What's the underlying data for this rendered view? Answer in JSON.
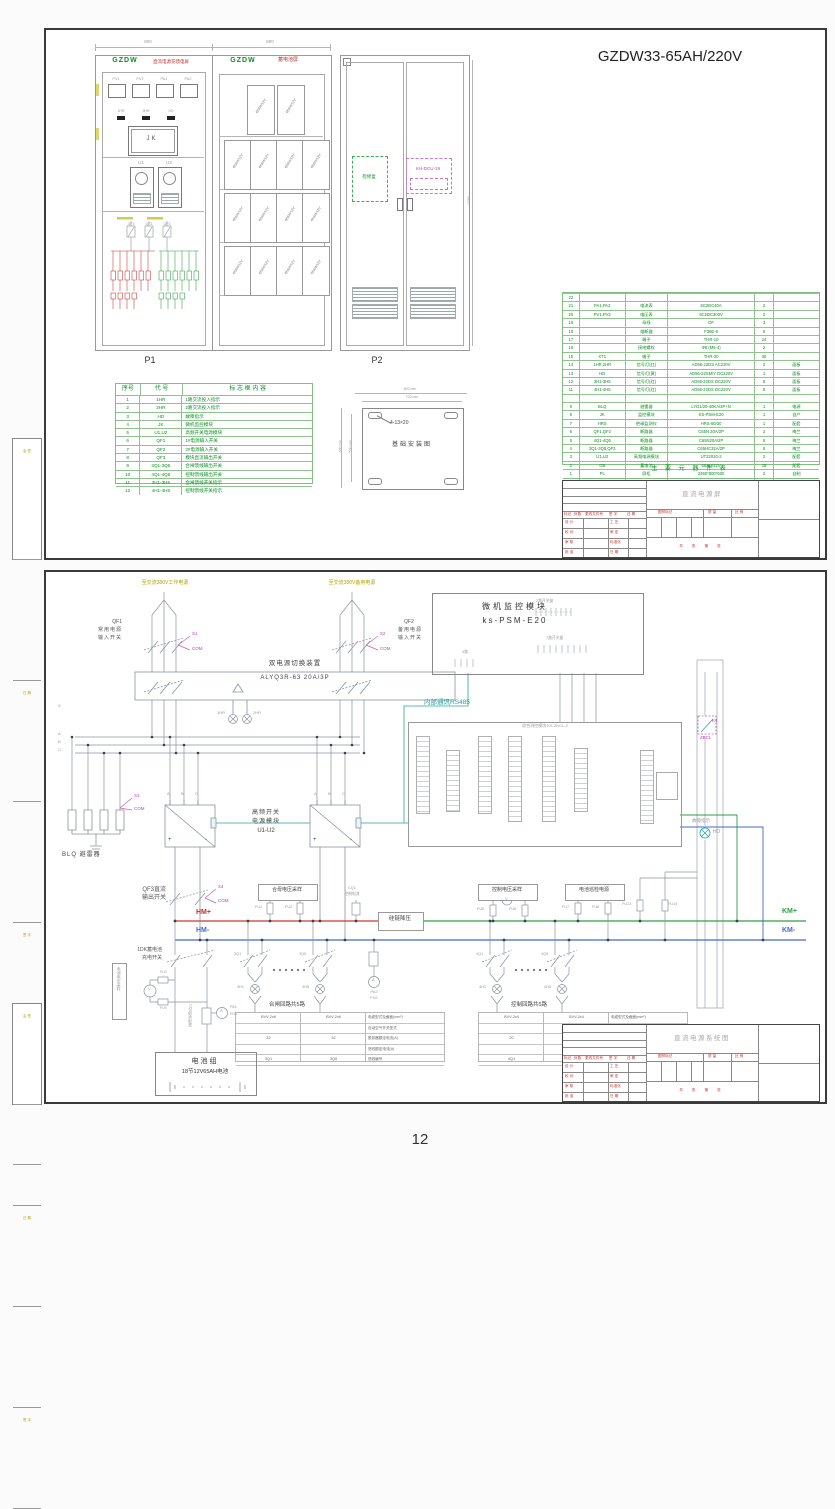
{
  "page": {
    "number": "12"
  },
  "margin": {
    "labels": [
      "会 签",
      "日 期",
      "签 字",
      "审 定"
    ]
  },
  "titleblock": {
    "rev_cols": [
      "标记",
      "处数",
      "更改文件号",
      "签 字",
      "日 期"
    ],
    "sig_left": [
      "设 计",
      "校 对",
      "审 核",
      "批 准"
    ],
    "sig_right": [
      "工 艺",
      "审 定",
      "标准化",
      "日 期"
    ],
    "mark_cols": [
      "图样标记",
      "质 量",
      "比 例"
    ],
    "sheet_info": "共  张  第  张",
    "product1": "直流电源屏",
    "product2": "直流电源系统图"
  },
  "sheet1": {
    "title": "GZDW33-65AH/220V",
    "dims": {
      "w1": "800",
      "w2": "800",
      "h": "2360"
    },
    "p1": {
      "code": "GZDW",
      "name": "直流电源充馈电屏",
      "label": "P1",
      "meters": [
        "PV1",
        "PV2",
        "PA1",
        "PA2"
      ],
      "lamps": [
        "1HR",
        "2HR",
        "HD"
      ],
      "jk": "JK",
      "u": [
        "U1",
        "U2"
      ],
      "breakers": [
        "QF1",
        "QF2",
        "QF3"
      ]
    },
    "p2": {
      "code": "GZDW",
      "name": "蓄电池屏",
      "label": "P2",
      "battery": "65AH/12V"
    },
    "rear": {
      "jxh": "检修盒",
      "dcu": "KH-DCU-19"
    },
    "legend": {
      "headers": [
        "序号",
        "代  号",
        "标 志 框 内 容"
      ],
      "rows": [
        [
          "1",
          "1HR",
          "1路交流投入指示"
        ],
        [
          "2",
          "2HR",
          "2路交流投入指示"
        ],
        [
          "3",
          "HD",
          "故障指示"
        ],
        [
          "4",
          "JK",
          "微机监控模块"
        ],
        [
          "5",
          "U1,U2",
          "高频开关电源模块"
        ],
        [
          "6",
          "QF1",
          "1#电源输入开关"
        ],
        [
          "7",
          "QF2",
          "2#电源输入开关"
        ],
        [
          "8",
          "QF3",
          "模块直流输出开关"
        ],
        [
          "9",
          "3Q1-3Q5",
          "合闸馈线输出开关"
        ],
        [
          "10",
          "4Q1-4Q5",
          "控制馈线输出开关"
        ],
        [
          "11",
          "3H1-3H5",
          "合闸馈线开关指示"
        ],
        [
          "12",
          "4H1-4H5",
          "控制馈线开关指示"
        ]
      ]
    },
    "foundation": {
      "caption": "基础安装图",
      "w_outer": "800 mm",
      "w_inner": "700 mm",
      "h_outer": "600 mm",
      "h_inner": "500 mm",
      "slot": "4-13×20"
    },
    "bom": {
      "caption": "主 要 元 器 件 表",
      "headers": [
        "序号",
        "代 号",
        "名 称",
        "型 号 及 规 格",
        "数量",
        "备 注"
      ],
      "rows": [
        [
          "22",
          "",
          "",
          "",
          "",
          ""
        ],
        [
          "21",
          "PA1,PA2",
          "电流表",
          "6C2DC40A",
          "2",
          ""
        ],
        [
          "20",
          "PV1,PV2",
          "电压表",
          "6C2DC300V",
          "2",
          ""
        ],
        [
          "19",
          "",
          "母线",
          "OF",
          "3",
          ""
        ],
        [
          "18",
          "",
          "熔断器",
          "F36E-6",
          "5",
          ""
        ],
        [
          "17",
          "",
          "端子",
          "THR-10",
          "24",
          ""
        ],
        [
          "16",
          "",
          "接地螺栓",
          "Φ8 (M6-4)",
          "2",
          ""
        ],
        [
          "15",
          "XT1",
          "端子",
          "THR-30",
          "30",
          ""
        ],
        [
          "14",
          "1HR,2HR",
          "信号灯(红)",
          "AD56-22DS AC220V",
          "2",
          "面板"
        ],
        [
          "13",
          "HD",
          "信号灯(黄)",
          "AD56-22SM/Y DC220V",
          "1",
          "面板"
        ],
        [
          "12",
          "3H1-3H5",
          "信号灯(红)",
          "AD56-22DS DC220V",
          "5",
          "面板"
        ],
        [
          "11",
          "4H1-4H5",
          "信号灯(红)",
          "AD56-22DS DC220V",
          "5",
          "面板"
        ],
        [
          "",
          "",
          "",
          "",
          "",
          ""
        ],
        [
          "9",
          "BLQ",
          "避雷器",
          "LYD1/20-40KA/3P+N",
          "1",
          "电源"
        ],
        [
          "8",
          "JK",
          "监控模块",
          "KS-PSM-E20",
          "1",
          "自产"
        ],
        [
          "7",
          "HRS",
          "绝缘监测仪",
          "HRS-60/30",
          "1",
          "配套"
        ],
        [
          "6",
          "QF1,QF2",
          "断路器",
          "C65N 20A/2P",
          "2",
          "梅兰"
        ],
        [
          "5",
          "4Q1-4Q5",
          "断路器",
          "C65N20A/2P",
          "6",
          "梅兰"
        ],
        [
          "4",
          "3Q1-3Q5,QF3",
          "断路器",
          "C65HC32A/2P",
          "5",
          "梅兰"
        ],
        [
          "3",
          "U1,U2",
          "高频电源模块",
          "UT22010-2",
          "2",
          "配套"
        ],
        [
          "2",
          "GB",
          "蓄电池",
          "65AH/12V",
          "18",
          "配套"
        ],
        [
          "1",
          "PL",
          "屏柜",
          "2360*800*600",
          "2",
          "自制"
        ]
      ]
    }
  },
  "sheet2": {
    "src1": "至交流380V工作电源",
    "src2": "至交流380V备用电源",
    "qf1": {
      "code": "QF1",
      "l1": "常用电源",
      "l2": "输入开关",
      "s": "S1",
      "com": "COM"
    },
    "qf2": {
      "code": "QF2",
      "l1": "备用电源",
      "l2": "输入开关",
      "s": "S2",
      "com": "COM"
    },
    "ats": {
      "name": "双电源切换装置",
      "model": "ALYQ3R-63 20A/3P"
    },
    "lamp1": "1HR",
    "lamp2": "2HR",
    "monitor": {
      "name": "微机监控模块",
      "model": "ks-PSM-E20",
      "io1": "2路开关量",
      "io2": "7路开关量",
      "io3": "4路"
    },
    "rs485": "内部通讯RS485",
    "phases": [
      "X",
      "A",
      "B",
      "C"
    ],
    "blq": {
      "label": "BLQ 避雷器",
      "s": "S3",
      "com": "COM"
    },
    "modules": {
      "l1": "高频开关",
      "l2": "电源模块",
      "l3": "U1-U2",
      "a": "A",
      "b": "B",
      "c": "C",
      "plus": "+",
      "minus": "-"
    },
    "measure": {
      "title": "综合测控模块 KS-ZHCL-2"
    },
    "k4": {
      "l1": "K4",
      "l2": "ZBCL"
    },
    "fault": {
      "label": "故障指示",
      "code": "HD"
    },
    "qf3": {
      "l1": "QF3直流",
      "l2": "输出开关",
      "s": "S4",
      "com": "COM"
    },
    "buses": {
      "hmp": "HM+",
      "hmm": "HM-",
      "kmp": "KM+",
      "kmm": "KM-"
    },
    "gl": "硅链降压",
    "samp_hm": {
      "label": "合母电压采样",
      "f1": "FU1",
      "f2": "FU2"
    },
    "cq1": {
      "l1": "CQ1",
      "l2": "控制电流"
    },
    "samp_km": {
      "label": "控制电压采样",
      "f1": "FU5",
      "f2": "FU6",
      "v": "V"
    },
    "patrol": {
      "label": "电池巡检电源",
      "f1": "FU7",
      "f2": "FU8"
    },
    "fu13": "FU13",
    "fu14": "FU14",
    "shunt_mid": {
      "pa": "PA2",
      "fh": "FH2",
      "a": "A"
    },
    "feed_l": {
      "caption": "合闸回路共5路",
      "q1": "3Q1",
      "q5": "3Q5",
      "h1": "3H1",
      "h5": "3H5",
      "col1": [
        "BVV-2x6",
        "",
        "32",
        "",
        "3Q1"
      ],
      "col2": [
        "BVV-2x6",
        "",
        "32",
        "",
        "3Q5"
      ]
    },
    "feed_r": {
      "caption": "控制回路共5路",
      "q1": "4Q1",
      "q5": "4Q5",
      "h1": "4H1",
      "h5": "4H5",
      "col1": [
        "BVV-2x4",
        "",
        "20",
        "",
        "4Q1"
      ],
      "col2": [
        "BVV-2x4",
        "",
        "20",
        "",
        "4Q5"
      ]
    },
    "feed_headers": [
      "电缆型式及截面(mm²)",
      "自动空气开关型式",
      "脱扣器额定电流(A)",
      "馈线额定电流(A)",
      "馈线编号"
    ],
    "battery": {
      "sw1": "1DK蓄电池",
      "sw2": "充电开关",
      "vs": "电池电压采样",
      "f1": "FU3",
      "f2": "FU4",
      "v": "V",
      "a": "A",
      "cs": "CQ2电池电流",
      "pa": "PA1",
      "fh": "FH1",
      "pack": "电池组",
      "pack_sub": "18节12V65AH电池"
    }
  }
}
